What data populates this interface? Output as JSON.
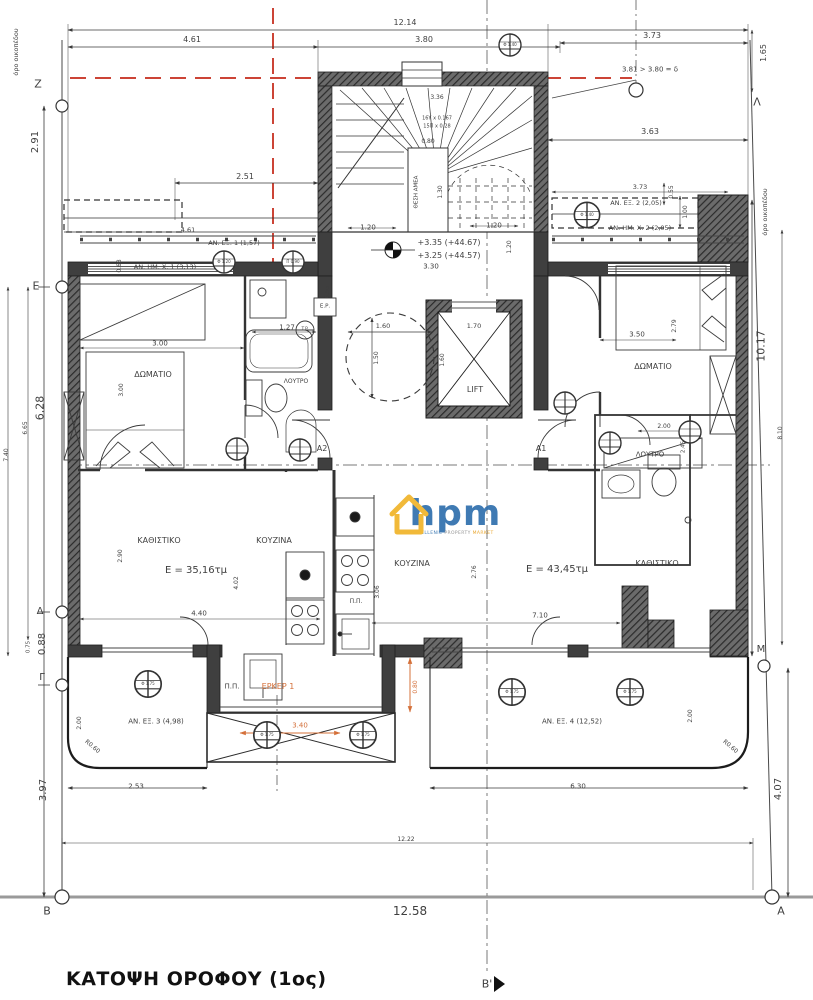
{
  "title": {
    "text": "ΚΑΤΟΨΗ ΟΡΟΦΟΥ (1ος)"
  },
  "logo": {
    "text": "hpm",
    "sub1": "HELLENIC",
    "sub2": "PROPERTY",
    "sub3": "MARKET"
  },
  "colors": {
    "accent_orange": "#d4703a",
    "setback_red": "#cc4436",
    "line": "#3f3f3f"
  },
  "labels": [
    {
      "t": "12.14",
      "x": 405,
      "y": 23,
      "s": 8,
      "n": "dim-top-overall"
    },
    {
      "t": "4.61",
      "x": 192,
      "y": 40,
      "s": 8,
      "n": "dim-label"
    },
    {
      "t": "3.80",
      "x": 424,
      "y": 40,
      "s": 8,
      "n": "dim-label"
    },
    {
      "t": "3.73",
      "x": 652,
      "y": 36,
      "s": 8,
      "n": "dim-label"
    },
    {
      "t": "3.81 > 3.80 = δ",
      "x": 650,
      "y": 70,
      "s": 7,
      "n": "setback-annotation"
    },
    {
      "t": "1.65",
      "x": 764,
      "y": 53,
      "s": 8,
      "r": -90,
      "n": "dim-label"
    },
    {
      "t": "όρο οικοπέδου",
      "x": 16,
      "y": 52,
      "s": 6.5,
      "r": -90,
      "n": "property-line-label"
    },
    {
      "t": "Z",
      "x": 38,
      "y": 84,
      "s": 11,
      "n": "grid-letter-z"
    },
    {
      "t": "Λ",
      "x": 757,
      "y": 102,
      "s": 11,
      "n": "grid-letter-lambda"
    },
    {
      "t": "2.91",
      "x": 36,
      "y": 142,
      "s": 10,
      "r": -90,
      "n": "dim-label"
    },
    {
      "t": "3.63",
      "x": 650,
      "y": 132,
      "s": 8,
      "n": "dim-label"
    },
    {
      "t": "2.51",
      "x": 245,
      "y": 177,
      "s": 8,
      "n": "dim-label"
    },
    {
      "t": "4.61",
      "x": 188,
      "y": 230,
      "s": 6.5,
      "n": "dim-label"
    },
    {
      "t": "AN. ΕΞ. 1 (1,57)",
      "x": 234,
      "y": 243,
      "s": 6.5,
      "n": "area-label-an-ex-1"
    },
    {
      "t": "AN. HM. X. 1 (3,13)",
      "x": 165,
      "y": 267,
      "s": 6.5,
      "n": "area-label-an-hm-x-1"
    },
    {
      "t": "0.68",
      "x": 120,
      "y": 266,
      "s": 6,
      "r": -90,
      "n": "dim-label"
    },
    {
      "t": "3.73",
      "x": 640,
      "y": 187,
      "s": 6.5,
      "n": "dim-label"
    },
    {
      "t": "AN. ΕΞ. 2 (2,05)",
      "x": 636,
      "y": 203,
      "s": 6.5,
      "n": "area-label-an-ex-2"
    },
    {
      "t": "AN. HM. X. 2 (2,05)",
      "x": 640,
      "y": 228,
      "s": 6.5,
      "n": "area-label-an-hm-x-2"
    },
    {
      "t": "0.55",
      "x": 672,
      "y": 192,
      "s": 6,
      "r": -90,
      "n": "dim-label"
    },
    {
      "t": "1.00",
      "x": 686,
      "y": 212,
      "s": 6,
      "r": -90,
      "n": "dim-label"
    },
    {
      "t": "όρο οικοπέδου",
      "x": 765,
      "y": 212,
      "s": 6.5,
      "r": -90,
      "n": "property-line-label"
    },
    {
      "t": "3.36",
      "x": 437,
      "y": 98,
      "s": 6,
      "n": "dim-label"
    },
    {
      "t": "16Υ x 0.167",
      "x": 437,
      "y": 119,
      "s": 5,
      "n": "stair-riser-label"
    },
    {
      "t": "15Π x 0.28",
      "x": 437,
      "y": 127,
      "s": 5,
      "n": "stair-tread-label"
    },
    {
      "t": "0.80",
      "x": 428,
      "y": 142,
      "s": 6,
      "n": "dim-label"
    },
    {
      "t": "ΘΕΣΗ ΑΜΕΑ",
      "x": 417,
      "y": 192,
      "s": 5.5,
      "r": -90,
      "n": "accessible-spot-label"
    },
    {
      "t": "1.30",
      "x": 441,
      "y": 192,
      "s": 6,
      "r": -90,
      "n": "dim-label"
    },
    {
      "t": "1.20",
      "x": 368,
      "y": 228,
      "s": 7,
      "n": "dim-label"
    },
    {
      "t": "1.20",
      "x": 494,
      "y": 226,
      "s": 7,
      "n": "dim-label"
    },
    {
      "t": "1.20",
      "x": 510,
      "y": 247,
      "s": 6,
      "r": -90,
      "n": "dim-label"
    },
    {
      "t": "+3.35 (+44.67)",
      "x": 449,
      "y": 243,
      "s": 8,
      "n": "level-label"
    },
    {
      "t": "+3.25 (+44.57)",
      "x": 449,
      "y": 256,
      "s": 8,
      "n": "level-label"
    },
    {
      "t": "3.30",
      "x": 431,
      "y": 267,
      "s": 7,
      "n": "dim-label"
    },
    {
      "t": "6.95",
      "x": 328,
      "y": 292,
      "s": 6,
      "r": -90,
      "n": "dim-label"
    },
    {
      "t": "Ε.Ρ.",
      "x": 325,
      "y": 307,
      "s": 5.5,
      "n": "shaft-label"
    },
    {
      "t": "T.P.",
      "x": 305,
      "y": 330,
      "s": 4.5,
      "n": "shaft-label"
    },
    {
      "t": "1.60",
      "x": 383,
      "y": 326,
      "s": 6.5,
      "n": "dim-label"
    },
    {
      "t": "1.50",
      "x": 377,
      "y": 358,
      "s": 6,
      "r": -90,
      "n": "dim-label"
    },
    {
      "t": "1.70",
      "x": 474,
      "y": 326,
      "s": 6.5,
      "n": "dim-label"
    },
    {
      "t": "1.60",
      "x": 443,
      "y": 360,
      "s": 6,
      "r": -90,
      "n": "dim-label"
    },
    {
      "t": "LIFT",
      "x": 475,
      "y": 390,
      "s": 8,
      "n": "lift-label"
    },
    {
      "t": "1.27",
      "x": 287,
      "y": 328,
      "s": 7,
      "n": "dim-label"
    },
    {
      "t": "3.00",
      "x": 160,
      "y": 344,
      "s": 7,
      "n": "dim-label"
    },
    {
      "t": "3.00",
      "x": 122,
      "y": 390,
      "s": 6,
      "r": -90,
      "n": "dim-label"
    },
    {
      "t": "ΔΩΜΑΤΙΟ",
      "x": 153,
      "y": 375,
      "s": 8,
      "n": "room-label-bedroom-left"
    },
    {
      "t": "ΛΟΥΤΡΟ",
      "x": 296,
      "y": 382,
      "s": 6,
      "n": "room-label-bath-left"
    },
    {
      "t": "A2",
      "x": 322,
      "y": 449,
      "s": 8,
      "n": "door-label-a2"
    },
    {
      "t": "A1",
      "x": 541,
      "y": 449,
      "s": 8,
      "n": "door-label-a1"
    },
    {
      "t": "ΚΑΘΙΣΤΙΚΟ",
      "x": 159,
      "y": 541,
      "s": 8,
      "n": "room-label-living-left"
    },
    {
      "t": "E = 35,16τμ",
      "x": 196,
      "y": 571,
      "s": 10,
      "n": "area-value-left"
    },
    {
      "t": "ΚΟΥΖΙΝΑ",
      "x": 274,
      "y": 541,
      "s": 8,
      "n": "room-label-kitchen-left"
    },
    {
      "t": "2.90",
      "x": 121,
      "y": 556,
      "s": 6,
      "r": -90,
      "n": "dim-label"
    },
    {
      "t": "4.02",
      "x": 237,
      "y": 583,
      "s": 6,
      "r": -90,
      "n": "dim-label"
    },
    {
      "t": "4.40",
      "x": 199,
      "y": 614,
      "s": 7,
      "n": "dim-label"
    },
    {
      "t": "ΔΩΜΑΤΙΟ",
      "x": 653,
      "y": 367,
      "s": 8,
      "n": "room-label-bedroom-right"
    },
    {
      "t": "3.50",
      "x": 637,
      "y": 335,
      "s": 7,
      "n": "dim-label"
    },
    {
      "t": "2.79",
      "x": 675,
      "y": 326,
      "s": 6,
      "r": -90,
      "n": "dim-label"
    },
    {
      "t": "2.00",
      "x": 664,
      "y": 427,
      "s": 6,
      "n": "dim-label"
    },
    {
      "t": "2.45",
      "x": 684,
      "y": 447,
      "s": 5.5,
      "r": -90,
      "n": "dim-label"
    },
    {
      "t": "ΛΟΥΤΡΟ",
      "x": 650,
      "y": 455,
      "s": 7,
      "n": "room-label-bath-right"
    },
    {
      "t": "ΚΟΥΖΙΝΑ",
      "x": 412,
      "y": 564,
      "s": 8,
      "n": "room-label-kitchen-right"
    },
    {
      "t": "2.76",
      "x": 475,
      "y": 572,
      "s": 6,
      "r": -90,
      "n": "dim-label"
    },
    {
      "t": "E = 43,45τμ",
      "x": 557,
      "y": 570,
      "s": 10,
      "n": "area-value-right"
    },
    {
      "t": "ΚΑΘΙΣΤΙΚΟ",
      "x": 657,
      "y": 564,
      "s": 8,
      "n": "room-label-living-right"
    },
    {
      "t": "7.10",
      "x": 540,
      "y": 616,
      "s": 7,
      "n": "dim-label"
    },
    {
      "t": "3.06",
      "x": 378,
      "y": 592,
      "s": 6,
      "r": -90,
      "n": "dim-label"
    },
    {
      "t": "Π.Π.",
      "x": 356,
      "y": 602,
      "s": 6,
      "n": "pp-label"
    },
    {
      "t": "Π.Π.",
      "x": 232,
      "y": 687,
      "s": 7,
      "n": "pp-label"
    },
    {
      "t": "ΕΡΚΕΡ 1",
      "x": 278,
      "y": 687,
      "s": 8,
      "cls": "orange",
      "n": "bay-window-label"
    },
    {
      "t": "3.40",
      "x": 300,
      "y": 726,
      "s": 7,
      "cls": "orange",
      "n": "dim-label"
    },
    {
      "t": "0.80",
      "x": 416,
      "y": 687,
      "s": 6,
      "r": -90,
      "cls": "orange",
      "n": "dim-label"
    },
    {
      "t": "AN. ΕΞ. 3 (4,98)",
      "x": 156,
      "y": 722,
      "s": 7,
      "n": "area-label-an-ex-3"
    },
    {
      "t": "2.00",
      "x": 80,
      "y": 723,
      "s": 6,
      "r": -90,
      "n": "dim-label"
    },
    {
      "t": "R0.60",
      "x": 92,
      "y": 747,
      "s": 6,
      "r": 40,
      "n": "radius-label"
    },
    {
      "t": "2.53",
      "x": 136,
      "y": 787,
      "s": 7,
      "n": "dim-label"
    },
    {
      "t": "AN. ΕΞ. 4 (12,52)",
      "x": 572,
      "y": 722,
      "s": 7,
      "n": "area-label-an-ex-4"
    },
    {
      "t": "2.00",
      "x": 691,
      "y": 716,
      "s": 6,
      "r": -90,
      "n": "dim-label"
    },
    {
      "t": "R0.60",
      "x": 730,
      "y": 747,
      "s": 6,
      "r": 40,
      "n": "radius-label"
    },
    {
      "t": "6.30",
      "x": 578,
      "y": 787,
      "s": 7,
      "n": "dim-label"
    },
    {
      "t": "3.97",
      "x": 44,
      "y": 790,
      "s": 10,
      "r": -90,
      "n": "dim-label"
    },
    {
      "t": "4.07",
      "x": 779,
      "y": 789,
      "s": 10,
      "r": -90,
      "n": "dim-label"
    },
    {
      "t": "12.22",
      "x": 406,
      "y": 840,
      "s": 6,
      "n": "dim-label"
    },
    {
      "t": "12.58",
      "x": 410,
      "y": 911,
      "s": 12,
      "n": "dim-label"
    },
    {
      "t": "B",
      "x": 47,
      "y": 911,
      "s": 11,
      "n": "grid-letter-b"
    },
    {
      "t": "A",
      "x": 781,
      "y": 911,
      "s": 11,
      "n": "grid-letter-a"
    },
    {
      "t": "Β'",
      "x": 487,
      "y": 984,
      "s": 11,
      "n": "section-marker-b-prime"
    },
    {
      "t": "Ε",
      "x": 36,
      "y": 286,
      "s": 11,
      "n": "grid-letter-e"
    },
    {
      "t": "6.28",
      "x": 40,
      "y": 408,
      "s": 11,
      "r": -90,
      "n": "dim-label"
    },
    {
      "t": "6.65",
      "x": 26,
      "y": 428,
      "s": 6,
      "r": -90,
      "n": "dim-label"
    },
    {
      "t": "7.40",
      "x": 7,
      "y": 455,
      "s": 6,
      "r": -90,
      "n": "dim-label"
    },
    {
      "t": "Δ",
      "x": 40,
      "y": 612,
      "s": 10,
      "n": "grid-letter-delta"
    },
    {
      "t": "0.88",
      "x": 43,
      "y": 644,
      "s": 10,
      "r": -90,
      "n": "dim-label"
    },
    {
      "t": "0.75",
      "x": 29,
      "y": 647,
      "s": 5.5,
      "r": -90,
      "n": "dim-label"
    },
    {
      "t": "Γ",
      "x": 42,
      "y": 678,
      "s": 10,
      "n": "grid-letter-gamma"
    },
    {
      "t": "10.17",
      "x": 761,
      "y": 346,
      "s": 11,
      "r": -90,
      "n": "dim-label"
    },
    {
      "t": "8.10",
      "x": 781,
      "y": 433,
      "s": 6,
      "r": -90,
      "n": "dim-label"
    },
    {
      "t": "M",
      "x": 761,
      "y": 650,
      "s": 10,
      "n": "grid-letter-m"
    },
    {
      "t": "Φ 1.40",
      "x": 510,
      "y": 45,
      "s": 4,
      "n": "column-marker-label"
    },
    {
      "t": "Φ 1.20",
      "x": 224,
      "y": 262,
      "s": 4,
      "n": "column-marker-label"
    },
    {
      "t": "Π 0.90",
      "x": 293,
      "y": 262,
      "s": 4,
      "n": "column-marker-label"
    },
    {
      "t": "Φ 1.40",
      "x": 587,
      "y": 215,
      "s": 4,
      "n": "column-marker-label"
    },
    {
      "t": "Φ 1.75",
      "x": 148,
      "y": 684,
      "s": 4,
      "n": "column-marker-label"
    },
    {
      "t": "Φ 1.75",
      "x": 267,
      "y": 735,
      "s": 4,
      "n": "column-marker-label"
    },
    {
      "t": "Φ 1.75",
      "x": 363,
      "y": 735,
      "s": 4,
      "n": "column-marker-label"
    },
    {
      "t": "Φ 1.75",
      "x": 512,
      "y": 692,
      "s": 4,
      "n": "column-marker-label"
    },
    {
      "t": "Φ 1.75",
      "x": 630,
      "y": 692,
      "s": 4,
      "n": "column-marker-label"
    }
  ]
}
